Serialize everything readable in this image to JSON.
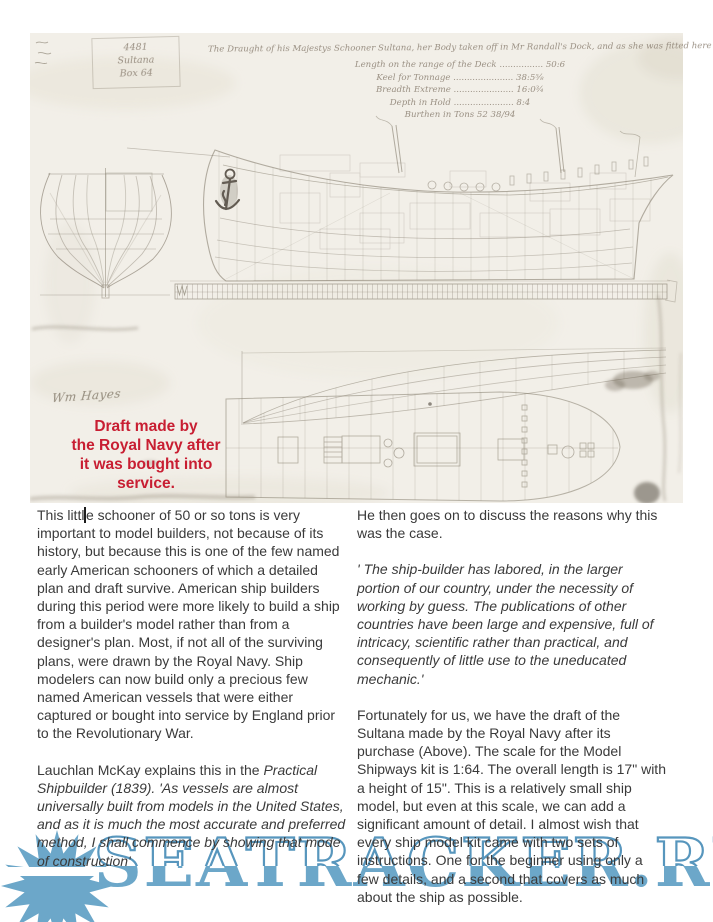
{
  "scan": {
    "corner_label": {
      "lines": [
        "4481",
        "Sultana",
        "Box 64"
      ]
    },
    "handwriting": {
      "title": "The Draught of his Majestys Schooner Sultana, her Body taken off in Mr Randall's Dock, and as she was fitted here",
      "dimension_lines": [
        "Length on the range of the Deck ................ 50:6",
        "Keel for Tonnage ...................... 38:5⅝",
        "Breadth Extreme ...................... 16:0¾",
        "Depth in Hold ...................... 8:4",
        "Burthen in Tons 52 38/94"
      ]
    },
    "signature": "Wm Hayes",
    "caption": {
      "color": "#c81e32",
      "lines": [
        "Draft made by",
        "the Royal Navy after",
        "it was bought into",
        "service."
      ]
    }
  },
  "article": {
    "text_color": "#3a3a3a",
    "left_column": {
      "p1_before_cursor": "This littl",
      "p1_after_cursor": "e schooner of 50 or so tons is very important to model builders, not because of its history, but because this is one of the few named early American schooners of which a detailed plan and draft survive. American ship builders during this period were more likely to build a ship from a builder's model rather than from a designer's plan. Most, if not all of the surviving plans, were drawn by the Royal Navy. Ship modelers can now build only a precious few named American vessels that were either captured or bought into service by England prior to the Revolutionary War.",
      "p2_intro": "Lauchlan McKay explains this in the ",
      "p2_italic": "Practical Shipbuilder (1839).  'As vessels are almost universally built from models in the United States, and as it is much the most accurate and preferred method, I shall commence by showing that mode of construction'"
    },
    "right_column": {
      "p1": "He then goes on to discuss the reasons why this was the case.",
      "p2": "' The ship-builder has labored,  in the larger portion of our country, under the necessity of working by guess.  The publications of other countries have been large and expensive, full of intricacy, scientific rather than practical, and consequently of little use to the uneducated mechanic.'",
      "p3": "Fortunately for us, we have the draft of the Sultana made by the Royal Navy after its purchase (Above). The scale for the Model Shipways kit is 1:64. The overall length is 17\" with a height of 15\". This is a relatively small ship model, but even at this scale, we can add a significant amount of detail. I almost wish that every ship model kit came with two sets of instructions. One for the beginner using only a few details, and a second that covers as much about the ship as possible."
    }
  },
  "watermark": {
    "text": "SEATRACKER.RU",
    "color": "#6ca7c9"
  }
}
